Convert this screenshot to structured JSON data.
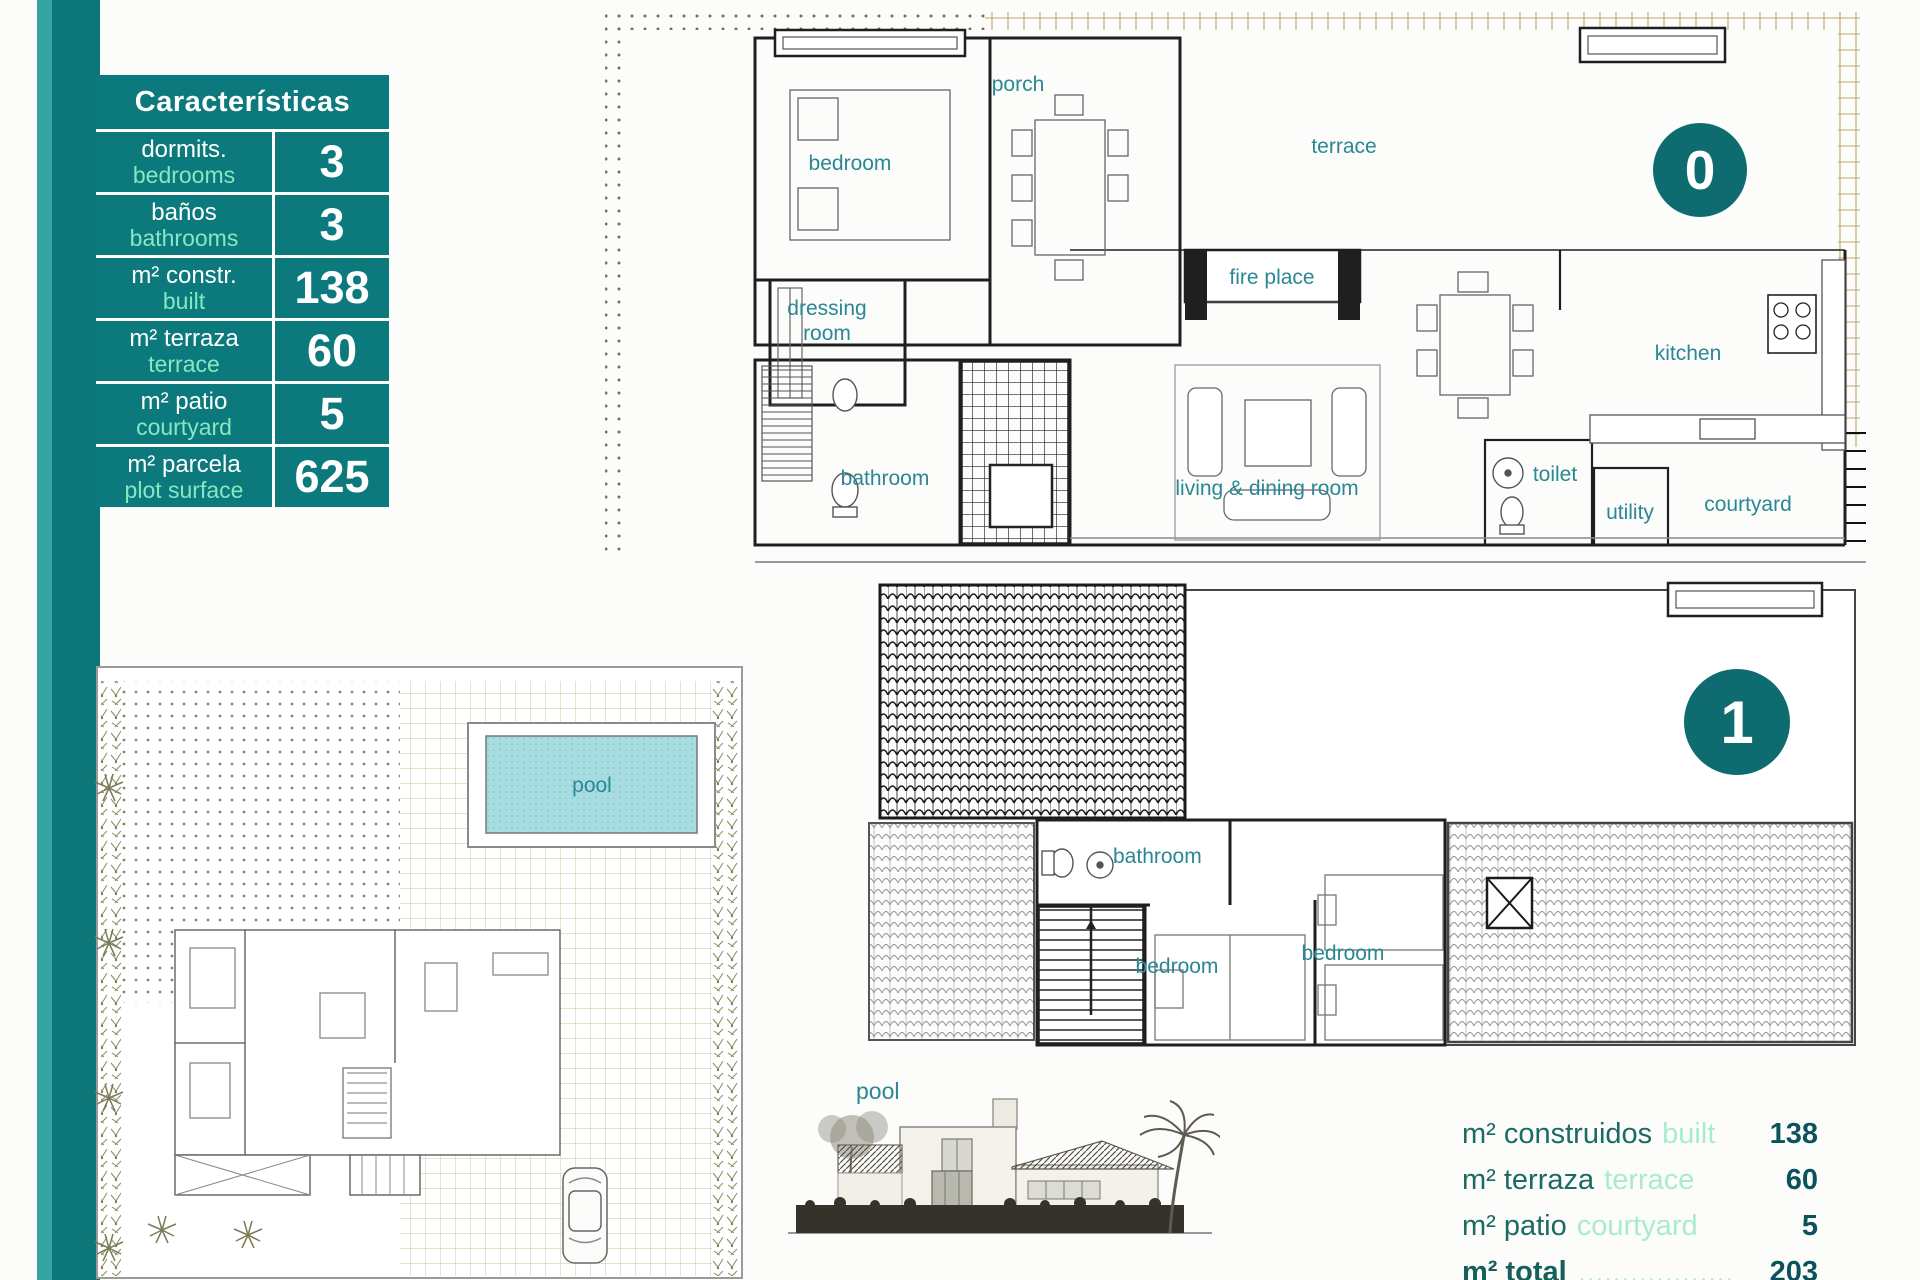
{
  "colors": {
    "accent_teal": "#0c7a7c",
    "badge_teal": "#0e6c70",
    "light_green": "#86e7c0",
    "room_label_teal": "#2a8794",
    "summary_dark_teal": "#1c6b63",
    "summary_number": "#0a535c",
    "tan_hatch": "#cdbf92",
    "pool_fill": "#a7dde0"
  },
  "characteristics_table": {
    "title": "Características",
    "rows": [
      {
        "es": "dormits.",
        "en": "bedrooms",
        "value": "3"
      },
      {
        "es": "baños",
        "en": "bathrooms",
        "value": "3"
      },
      {
        "es": "m² constr.",
        "en": "built",
        "value": "138"
      },
      {
        "es": "m² terraza",
        "en": "terrace",
        "value": "60"
      },
      {
        "es": "m² patio",
        "en": "courtyard",
        "value": "5"
      },
      {
        "es": "m² parcela",
        "en": "plot surface",
        "value": "625"
      }
    ]
  },
  "floor0": {
    "badge": "0",
    "labels": {
      "bedroom": "bedroom",
      "porch": "porch",
      "terrace": "terrace",
      "dressing_line1": "dressing",
      "dressing_line2": "room",
      "fireplace": "fire place",
      "bathroom": "bathroom",
      "living": "living & dining room",
      "kitchen": "kitchen",
      "toilet": "toilet",
      "utility": "utility",
      "courtyard": "courtyard"
    }
  },
  "floor1": {
    "badge": "1",
    "labels": {
      "bathroom": "bathroom",
      "bedroom_left": "bedroom",
      "bedroom_right": "bedroom",
      "pool": "pool"
    }
  },
  "site_plan": {
    "pool": "pool"
  },
  "summary": {
    "rows": [
      {
        "es": "m² construidos",
        "en": "built",
        "value": "138"
      },
      {
        "es": "m² terraza",
        "en": "terrace",
        "value": "60"
      },
      {
        "es": "m² patio",
        "en": "courtyard",
        "value": "5"
      }
    ],
    "total": {
      "es": "m² total",
      "dots": "..................",
      "value": "203"
    }
  }
}
